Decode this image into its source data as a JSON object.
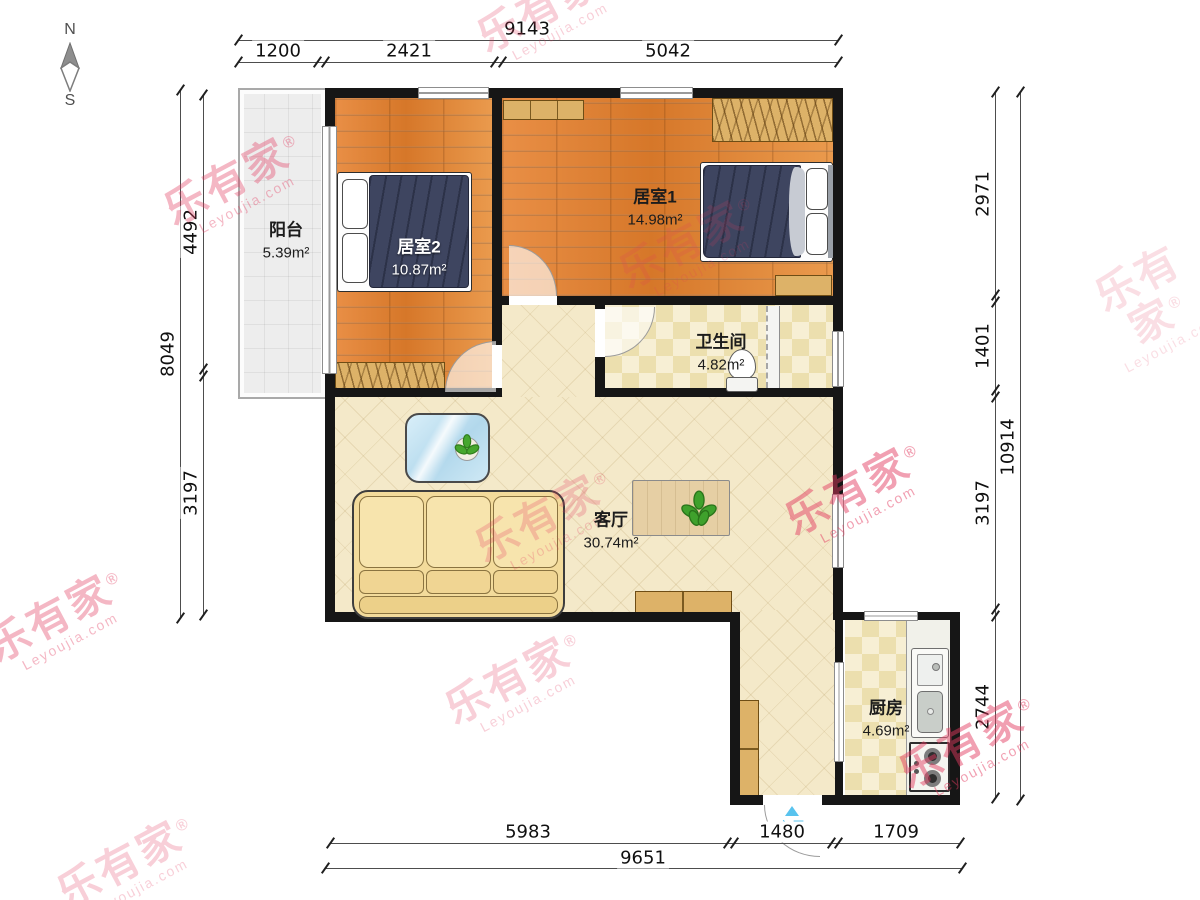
{
  "compass": {
    "north": "N",
    "south": "S"
  },
  "watermark": {
    "brand": "乐有家",
    "reg": "®",
    "domain": "Leyoujia.com"
  },
  "rooms": [
    {
      "name": "阳台",
      "area": "5.39m²"
    },
    {
      "name": "居室2",
      "area": "10.87m²"
    },
    {
      "name": "居室1",
      "area": "14.98m²"
    },
    {
      "name": "卫生间",
      "area": "4.82m²"
    },
    {
      "name": "客厅",
      "area": "30.74m²"
    },
    {
      "name": "厨房",
      "area": "4.69m²"
    }
  ],
  "entrance": {
    "label": "入口"
  },
  "dims": {
    "top": {
      "overall": "9143",
      "segments": [
        "1200",
        "2421",
        "5042"
      ]
    },
    "left": {
      "overall": "8049",
      "segments": [
        "4492",
        "3197"
      ]
    },
    "right": {
      "overall": "10914",
      "segments": [
        "2971",
        "1401",
        "3197",
        "2744"
      ]
    },
    "bottom": {
      "overall": "9651",
      "segments": [
        "5983",
        "1480",
        "1709"
      ]
    }
  }
}
